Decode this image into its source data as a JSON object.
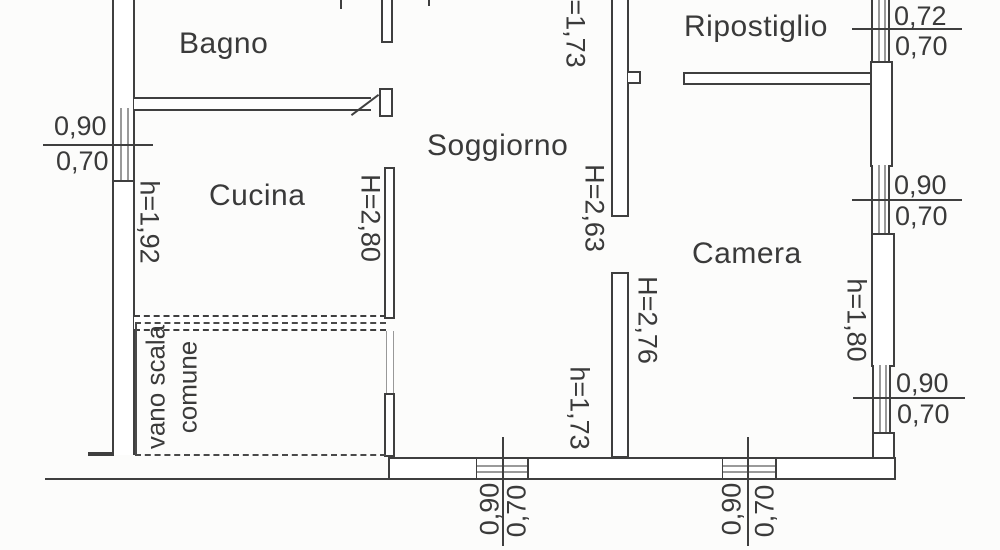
{
  "rooms": {
    "bagno": "Bagno",
    "cucina": "Cucina",
    "soggiorno": "Soggiorno",
    "ripostiglio": "Ripostiglio",
    "camera": "Camera",
    "vano_scala_line1": "vano scala",
    "vano_scala_line2": "comune"
  },
  "wall_heights": {
    "kitchen_left_wall": "h=1,92",
    "kitchen_living_wall": "H=2,80",
    "top_opening": "h=1,73",
    "living_room": "H=2,63",
    "living_camera_wall": "H=2,76",
    "bottom_opening": "h=1,73",
    "camera_right_wall": "h=1,80"
  },
  "windows": {
    "left": {
      "label_top": "0,90",
      "label_bottom": "0,70"
    },
    "right_top": {
      "label_top": "0,72",
      "label_bottom": "0,70"
    },
    "right_middle": {
      "label_top": "0,90",
      "label_bottom": "0,70"
    },
    "right_bottom": {
      "label_top": "0,90",
      "label_bottom": "0,70"
    },
    "bottom_left": {
      "label_left": "0,90",
      "label_right": "0,70"
    },
    "bottom_right": {
      "label_left": "0,90",
      "label_right": "0,70"
    }
  },
  "colors": {
    "line": "#3f3f3f",
    "text": "#3a3a3a",
    "background": "#fcfcfb"
  }
}
